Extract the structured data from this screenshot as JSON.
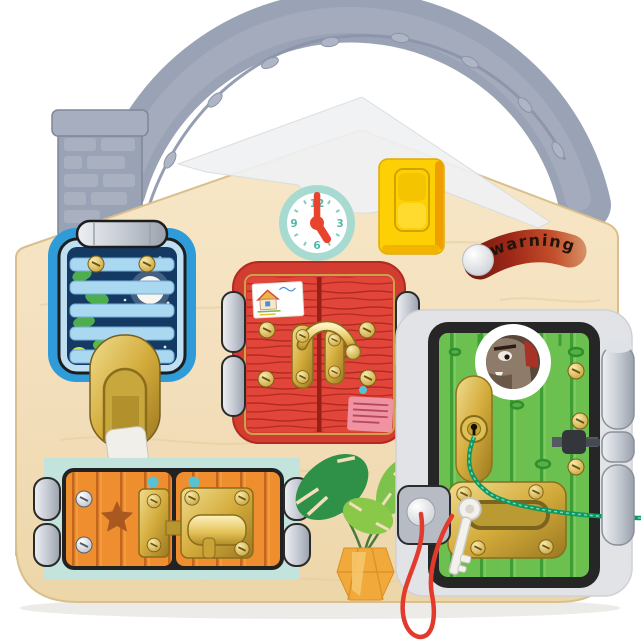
{
  "labels": {
    "warning": "warning"
  },
  "clock": {
    "numbers": [
      "12",
      "3",
      "6",
      "9"
    ],
    "minute_hand_angle_deg": 0,
    "hour_hand_angle_deg": 148
  },
  "colors": {
    "background": "#ffffff",
    "wood": "#f3debb",
    "wood_edge": "#d9bf8d",
    "handle_gray": "#9aa3b5",
    "handle_dark": "#848da0",
    "roof_cap": "#eff1f3",
    "clock_ring": "#a7dbd2",
    "clock_hands": "#e8432c",
    "clock_numbers": "#53b8aa",
    "switch_yellow": "#fdd005",
    "switch_edge": "#ef9f00",
    "warning_red": "#a02818",
    "warning_text": "#241309",
    "window_blue": "#2f9cd9",
    "window_frame_light": "#bfe0f2",
    "night_sky": "#143a64",
    "slat_blue": "#a9d8f0",
    "leaf_green": "#4cae4e",
    "gold": "#d8b84a",
    "silver": "#c7ccd4",
    "red_frame": "#d23c31",
    "red_door": "#e2463a",
    "red_grain": "#a6241a",
    "sticker_pink": "#ef93a2",
    "mint": "#c2e4dc",
    "orange_door": "#ef8e2f",
    "orange_grain": "#c1661c",
    "star_brown": "#a9581f",
    "teal_dot": "#55c3d3",
    "green_door": "#6cc04f",
    "green_plank": "#3f9e33",
    "frame_black": "#262626",
    "surround_gray": "#e2e3e6",
    "wolf_brown": "#8e7b6a",
    "string_red": "#e23b2e",
    "string_green": "#0c9a64",
    "key_white": "#f3f1ec",
    "plant_dark": "#2f9147",
    "plant_light": "#8ac84a",
    "vase_yellow": "#f1a93c"
  },
  "parts": [
    "vine-handle",
    "brick-chimney",
    "roof-cap",
    "teaching-clock",
    "light-switch",
    "warning-slider",
    "window-with-blinds",
    "gold-flip-latch",
    "red-double-doors",
    "hook-latch",
    "barn-doors",
    "barrel-bolt",
    "green-door",
    "peephole-wolf",
    "keyhole",
    "gold-strike-plate",
    "door-bolt",
    "hinges",
    "red-string-with-key",
    "green-cord",
    "monstera-plant"
  ]
}
